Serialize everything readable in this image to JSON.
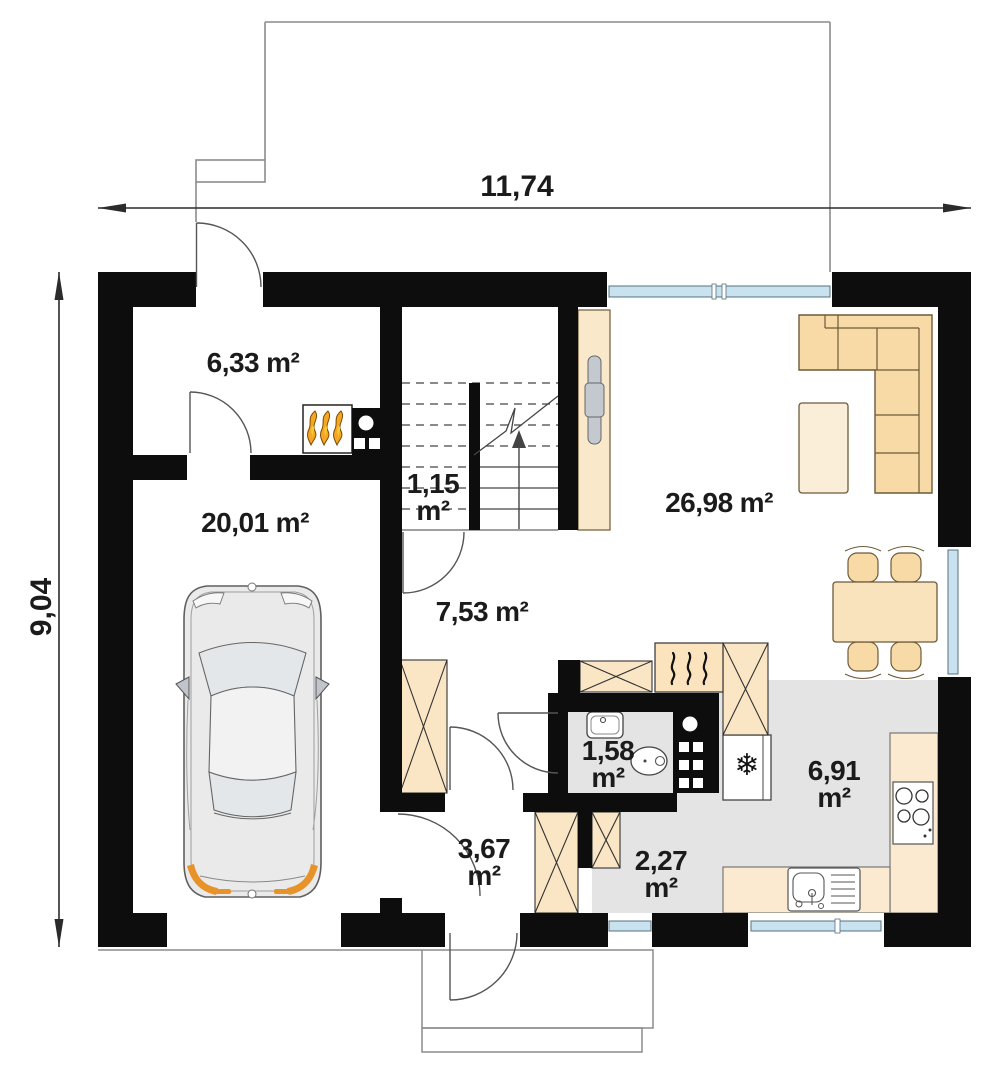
{
  "plan_type": "floor-plan",
  "dimensions": {
    "width_label": "11,74",
    "height_label": "9,04"
  },
  "rooms": [
    {
      "name": "boiler-room",
      "area": "6,33",
      "unit": "m²"
    },
    {
      "name": "garage",
      "area": "20,01",
      "unit": "m²"
    },
    {
      "name": "staircase",
      "area": "1,15",
      "unit": "m²"
    },
    {
      "name": "hall",
      "area": "7,53",
      "unit": "m²"
    },
    {
      "name": "living-room",
      "area": "26,98",
      "unit": "m²"
    },
    {
      "name": "toilet",
      "area": "1,58",
      "unit": "m²"
    },
    {
      "name": "entry-hall",
      "area": "3,67",
      "unit": "m²"
    },
    {
      "name": "corridor",
      "area": "2,27",
      "unit": "m²"
    },
    {
      "name": "kitchen",
      "area": "6,91",
      "unit": "m²"
    }
  ],
  "icons": {
    "fridge": "❄"
  },
  "colors": {
    "wall": "#0d0d0d",
    "furniture": "#F7DAA6",
    "furniture_light": "#FBEED8",
    "cabinet": "#FAE6C4",
    "counter": "#FBEAD0",
    "floor_tile": "#E4E4E4",
    "window_glass": "#C9E2F0",
    "accent_orange": "#E8922A",
    "flame_yellow": "#F7C832",
    "text": "#1b1b1b"
  }
}
